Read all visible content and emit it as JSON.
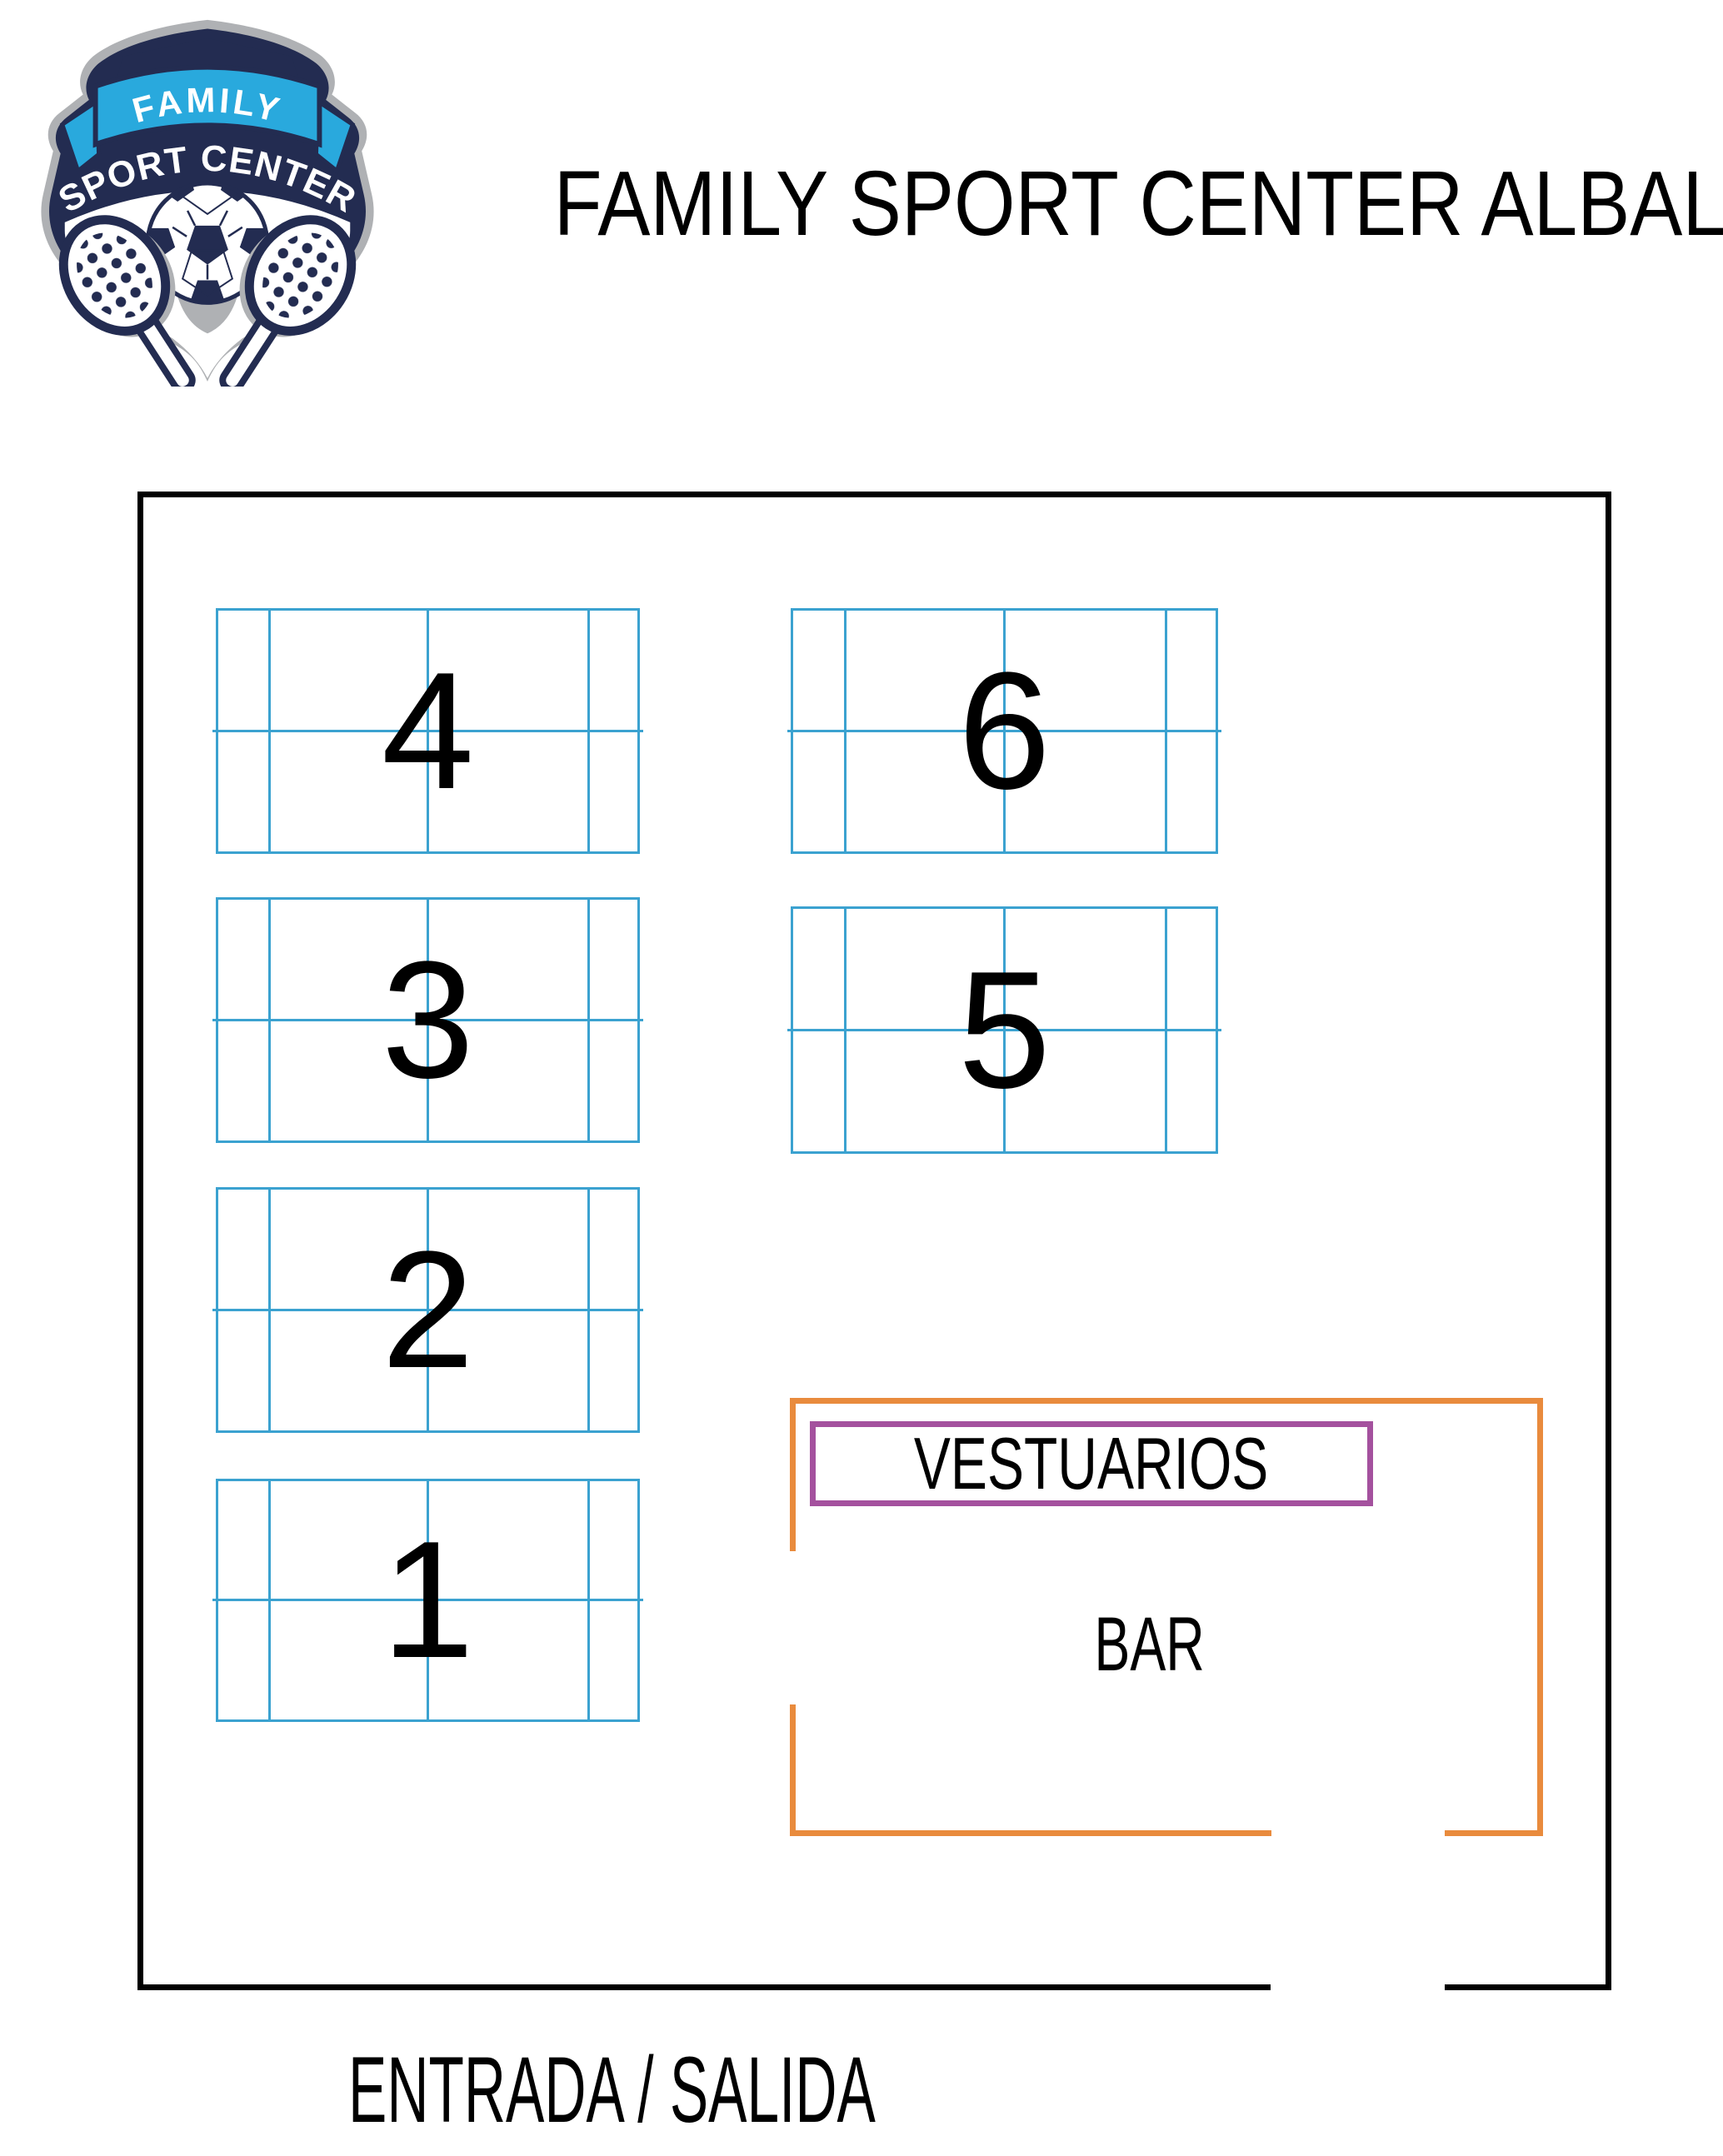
{
  "logo": {
    "banner_text": "FAMILY",
    "arc_text": "SPORT CENTER",
    "colors": {
      "navy": "#232C51",
      "light_blue": "#29A9DD",
      "gray": "#AFB1B4",
      "white": "#FFFFFF"
    }
  },
  "header": {
    "title": "FAMILY SPORT CENTER ALBAL"
  },
  "map": {
    "courts": [
      {
        "label": "1"
      },
      {
        "label": "2"
      },
      {
        "label": "3"
      },
      {
        "label": "4"
      },
      {
        "label": "5"
      },
      {
        "label": "6"
      }
    ],
    "vestuarios_label": "VESTUARIOS",
    "bar_label": "BAR",
    "entrance_label": "ENTRADA / SALIDA",
    "colors": {
      "wall": "#000000",
      "court_lines": "#3BA2D0",
      "bar_area_outline": "#E98B3D",
      "vestuarios_border": "#A4519E"
    }
  }
}
